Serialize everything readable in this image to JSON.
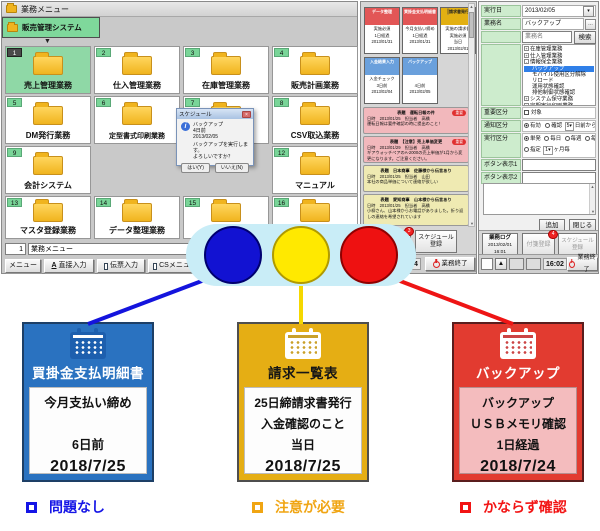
{
  "colors": {
    "status_blue": "#1414dd",
    "status_yellow": "#f5d800",
    "status_red": "#ee1515",
    "card_blue": "#2a72c0",
    "card_yellow": "#e5ae14",
    "card_red": "#e23b30",
    "menu_green": "#7fd89b"
  },
  "main_window": {
    "title": "業務メニュー",
    "tab_label": "販売管理システム",
    "cells": [
      {
        "num": "1",
        "label": "売上管理業務"
      },
      {
        "num": "2",
        "label": "仕入管理業務"
      },
      {
        "num": "3",
        "label": "在庫管理業務"
      },
      {
        "num": "4",
        "label": "販売計画業務"
      },
      {
        "num": "5",
        "label": "DM発行業務"
      },
      {
        "num": "6",
        "label": "定型書式印刷業務"
      },
      {
        "num": "7",
        "label": "受注連携業務"
      },
      {
        "num": "8",
        "label": "CSV取込業務"
      },
      {
        "num": "9",
        "label": "会計システム"
      },
      {
        "num": "10",
        "label": ""
      },
      {
        "num": "11",
        "label": ""
      },
      {
        "num": "12",
        "label": "マニュアル"
      },
      {
        "num": "13",
        "label": "マスタ登録業務"
      },
      {
        "num": "14",
        "label": "データ整理業務"
      },
      {
        "num": "15",
        "label": ""
      },
      {
        "num": "16",
        "label": ""
      }
    ],
    "dialog": {
      "title": "スケジュール",
      "name": "バックアップ",
      "elapsed": "4日前",
      "date": "2013/02/05",
      "message1": "バックアップを実行します。",
      "message2": "よろしいですか？",
      "yes_label": "はい(Y)",
      "no_label": "いいえ(N)",
      "close": "×"
    },
    "bottom": {
      "menu_no": "1",
      "menu_name": "業務メニュー",
      "btn_menu": "メニュー",
      "btn_direct": "直接入力",
      "btn_slip": "伝票入力",
      "btn_cs": "CSメニュー",
      "btn_zoom": "拡大鏡"
    }
  },
  "schedule_panel": {
    "cards": [
      {
        "title": "データ整理",
        "line1": "実施必須",
        "line2": "",
        "line3": "1日経過",
        "date": "2013/01/31"
      },
      {
        "title": "買掛金支払明細書",
        "line1": "今月支払い締め",
        "line2": "",
        "line3": "1日経過",
        "date": "2013/01/31"
      },
      {
        "title": "請求書発行",
        "line1": "実施の請求書",
        "line2": "実施必須",
        "line3": "当日",
        "date": "2013/02/01"
      },
      {
        "title": "入金結果入力",
        "line1": "入金チェック",
        "line2": "",
        "line3": "3日前",
        "date": "2013/02/04"
      },
      {
        "title": "バックアップ",
        "line1": "",
        "line2": "",
        "line3": "4日前",
        "date": "2013/02/05"
      }
    ],
    "notes": [
      {
        "title": "表題　運転日報の件",
        "badge": "重要",
        "meta": "日時　2013/01/25　担当者　高橋",
        "body": "運転日報は要件確認の時に提出のこと！"
      },
      {
        "title": "表題　【注意】売上単価変更",
        "badge": "重要",
        "meta": "日時　2013/01/29　担当者　高橋",
        "body": "ギアウォッチペアのA-2000の売上単価が1月から変更になります。ご注意ください。"
      },
      {
        "title": "表題　日本商事　佐藤様から伝言あり",
        "badge": "",
        "meta": "日時　2013/01/25　担当者　山田",
        "body": "本社の商品単価について連絡が欲しい"
      },
      {
        "title": "表題　愛知商事　山本様から伝言あり",
        "badge": "",
        "meta": "日時　2013/01/25　担当者　高橋",
        "body": "小柳さん、山本様からお電話がありました。折り返しの連絡を希望されています"
      }
    ],
    "fusen_label": "付箋登録",
    "fusen_badge": "3",
    "schedule_btn_1": "スケジュール",
    "schedule_btn_2": "登録",
    "time": "16:04",
    "end_label": "業務終了"
  },
  "form_panel": {
    "exec_date_label": "実行日",
    "exec_date": "2013/02/05",
    "task_label": "業務名",
    "task_value": "バックアップ",
    "search_placeholder": "業務名",
    "search_btn": "検索",
    "tree": [
      {
        "exp": "+",
        "label": "在庫管理業務"
      },
      {
        "exp": "+",
        "label": "仕入管理業務"
      },
      {
        "exp": "-",
        "label": "情報保全業務"
      },
      {
        "exp": "",
        "label": "バックアップ"
      },
      {
        "exp": "",
        "label": "モバイル使用区分解除"
      },
      {
        "exp": "",
        "label": "リロード"
      },
      {
        "exp": "",
        "label": "運用状態確認"
      },
      {
        "exp": "",
        "label": "排他制御状態確認"
      },
      {
        "exp": "+",
        "label": "システム保守業務"
      },
      {
        "exp": "+",
        "label": "定期実行印刷業務"
      }
    ],
    "important_label": "重要区分",
    "important_option": "対象",
    "notify_label": "通知区分",
    "notify_on": "有効",
    "notify_confirm": "確認",
    "notify_days": "5",
    "notify_suffix": "日前から",
    "exec_label": "実行区分",
    "exec_opt1": "単発",
    "exec_opt2": "毎日",
    "exec_opt3": "毎週",
    "exec_opt4": "毎月",
    "exec_custom": "指定",
    "exec_custom_val": "1",
    "exec_custom_suffix": "ヶ月毎",
    "btn1_label": "ボタン表示1",
    "btn2_label": "ボタン表示2",
    "add_btn": "追加",
    "close_btn": "閉じる",
    "log_l1": "業務ログ",
    "log_l2": "2013/02/01",
    "log_l3": "16:01",
    "fusen_label": "付箋登録",
    "fusen_badge": "4",
    "schedule_btn_1": "スケジュール",
    "schedule_btn_2": "登録",
    "time": "16:02",
    "end_label": "業務終了",
    "up_arrow": "▲"
  },
  "cards": [
    {
      "title": "買掛金支払明細書",
      "line1": "今月支払い締め",
      "line2": "",
      "line3": "6日前",
      "date": "2018/7/25"
    },
    {
      "title": "請求一覧表",
      "line1": "25日締請求書発行",
      "line2": "入金確認のこと",
      "line3": "当日",
      "date": "2018/7/25"
    },
    {
      "title": "バックアップ",
      "line1": "バックアップ",
      "line2": "ＵＳＢメモリ確認",
      "line3": "1日経過",
      "date": "2018/7/24"
    }
  ],
  "legend": [
    {
      "label": "問題なし"
    },
    {
      "label": "注意が必要"
    },
    {
      "label": "かならず確認"
    }
  ]
}
